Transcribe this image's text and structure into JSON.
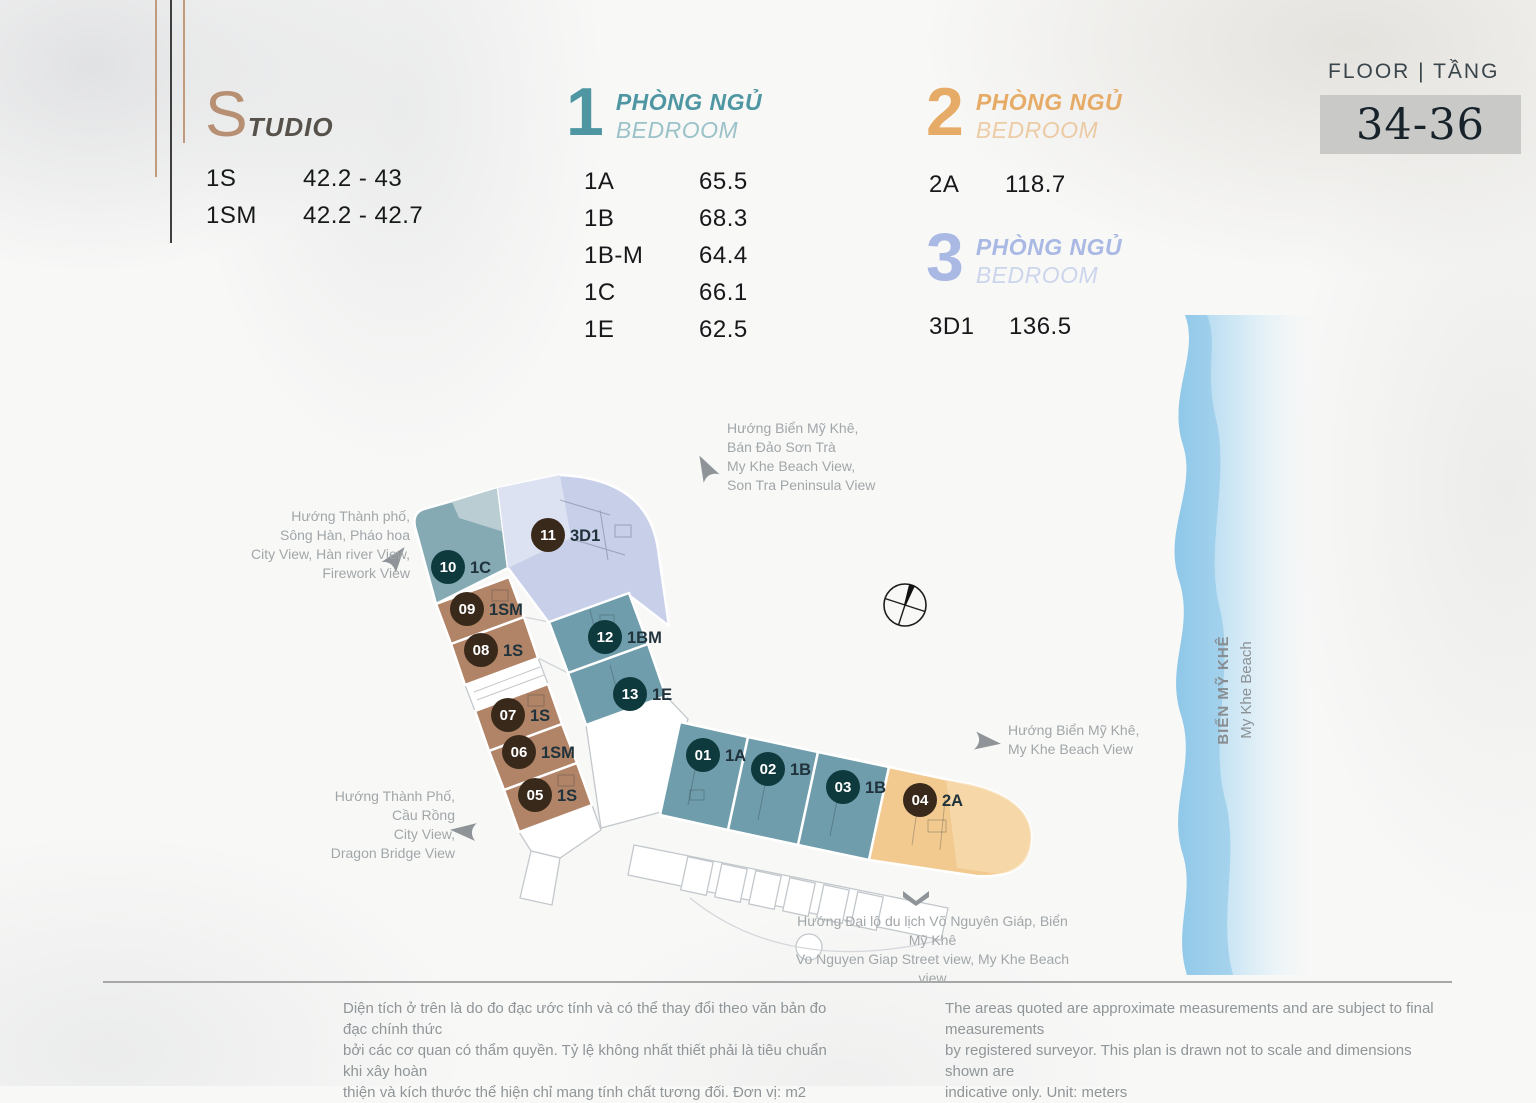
{
  "header": {
    "floor_label": "FLOOR | TẦNG",
    "floor_range": "34-36"
  },
  "legend": {
    "studio": {
      "initial": "S",
      "rest": "TUDIO",
      "rows": [
        {
          "code": "1S",
          "area": "42.2 - 43"
        },
        {
          "code": "1SM",
          "area": "42.2 - 42.7"
        }
      ]
    },
    "bed1": {
      "number": "1",
      "title_vi": "PHÒNG NGỦ",
      "title_en": "BEDROOM",
      "rows": [
        {
          "code": "1A",
          "area": "65.5"
        },
        {
          "code": "1B",
          "area": "68.3"
        },
        {
          "code": "1B-M",
          "area": "64.4"
        },
        {
          "code": "1C",
          "area": "66.1"
        },
        {
          "code": "1E",
          "area": "62.5"
        }
      ]
    },
    "bed2": {
      "number": "2",
      "title_vi": "PHÒNG NGỦ",
      "title_en": "BEDROOM",
      "rows": [
        {
          "code": "2A",
          "area": "118.7"
        }
      ]
    },
    "bed3": {
      "number": "3",
      "title_vi": "PHÒNG NGỦ",
      "title_en": "BEDROOM",
      "rows": [
        {
          "code": "3D1",
          "area": "136.5"
        }
      ]
    }
  },
  "plan": {
    "units": [
      {
        "num": "01",
        "type": "1A"
      },
      {
        "num": "02",
        "type": "1B"
      },
      {
        "num": "03",
        "type": "1B"
      },
      {
        "num": "04",
        "type": "2A"
      },
      {
        "num": "05",
        "type": "1S"
      },
      {
        "num": "06",
        "type": "1SM"
      },
      {
        "num": "07",
        "type": "1S"
      },
      {
        "num": "08",
        "type": "1S"
      },
      {
        "num": "09",
        "type": "1SM"
      },
      {
        "num": "10",
        "type": "1C"
      },
      {
        "num": "11",
        "type": "3D1"
      },
      {
        "num": "12",
        "type": "1BM"
      },
      {
        "num": "13",
        "type": "1E"
      }
    ]
  },
  "annotations": {
    "top": {
      "lines": [
        "Hướng Biển Mỹ Khê,",
        "Bán Đảo Sơn Trà",
        "My Khe Beach View,",
        "Son Tra Peninsula View"
      ]
    },
    "left": {
      "lines": [
        "Hướng Thành phố,",
        "Sông Hàn, Pháo hoa",
        "City View, Hàn river View,",
        "Firework View"
      ]
    },
    "bottom_left": {
      "lines": [
        "Hướng Thành Phố,",
        "Cầu Rồng",
        "City View,",
        "Dragon Bridge View"
      ]
    },
    "right": {
      "lines": [
        "Hướng Biển Mỹ Khê,",
        "My Khe Beach View"
      ]
    },
    "bottom": {
      "lines": [
        "Hướng Đại lộ du lịch Võ Nguyên Giáp, Biển Mỹ Khê",
        "Vo Nguyen Giap Street view, My Khe Beach view"
      ]
    }
  },
  "beach": {
    "vi": "BIỂN MỸ KHÊ",
    "en": "My Khe Beach"
  },
  "footer": {
    "vi": [
      "Diện tích ở trên là do đo đạc ước tính và có thể thay đổi theo văn bản đo đạc chính thức",
      "bởi các cơ quan có thẩm quyền. Tỷ lệ không nhất thiết phải là tiêu chuẩn khi xây hoàn",
      "thiện và kích thước thể hiện chỉ mang tính chất tương đối. Đơn vị: m2"
    ],
    "en": [
      "The areas quoted are approximate measurements and are subject to final measurements",
      "by registered surveyor. This plan is drawn not to scale and dimensions shown are",
      "indicative only. Unit: meters"
    ]
  },
  "colors": {
    "studio_tan": "#b78f72",
    "bed1_teal": "#4e96a2",
    "bed2_orange": "#e6ab66",
    "bed3_periwinkle": "#a9b9e4",
    "unit_fill_teal": "#6f9dab",
    "unit_fill_brown": "#b18468",
    "unit_fill_periwinkle": "#c7cfe9",
    "unit_fill_orange": "#f2ca90",
    "badge_teal": "#0e393d",
    "badge_brown": "#39291a",
    "beach_blue": "#8cc7e9",
    "floor_box_gray": "#c9cac8"
  }
}
